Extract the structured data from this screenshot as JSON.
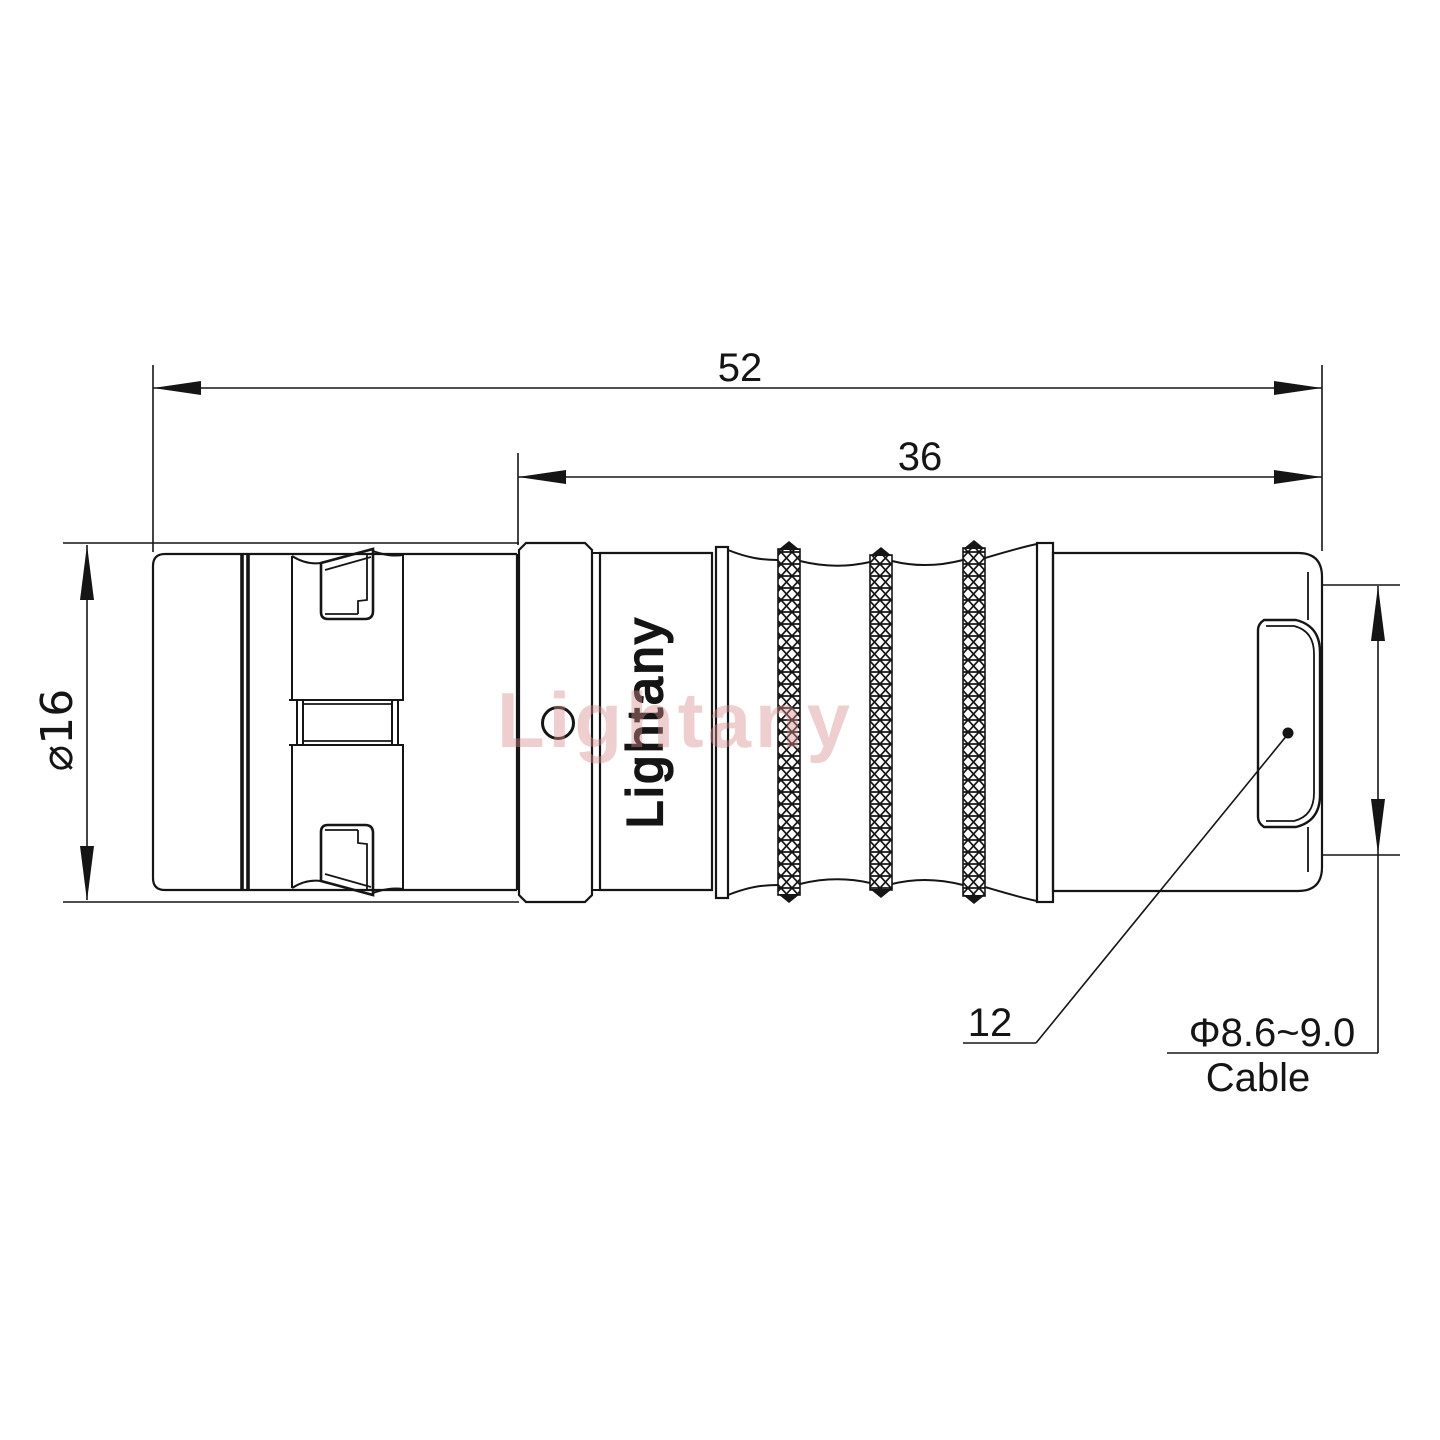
{
  "drawing": {
    "title": "cable connector plug technical drawing",
    "dimensions": {
      "total_length": "52",
      "grip_length": "36",
      "shell_diameter": "⌀16",
      "boot_size": "12",
      "cable_spec": "Φ8.6~9.0",
      "cable_word": "Cable"
    },
    "branding": {
      "engraved_logo": "Lightany",
      "watermark": "Lightany"
    },
    "colors": {
      "line": "#151515",
      "background": "#ffffff",
      "watermark_pink": "#d98c8c"
    }
  }
}
